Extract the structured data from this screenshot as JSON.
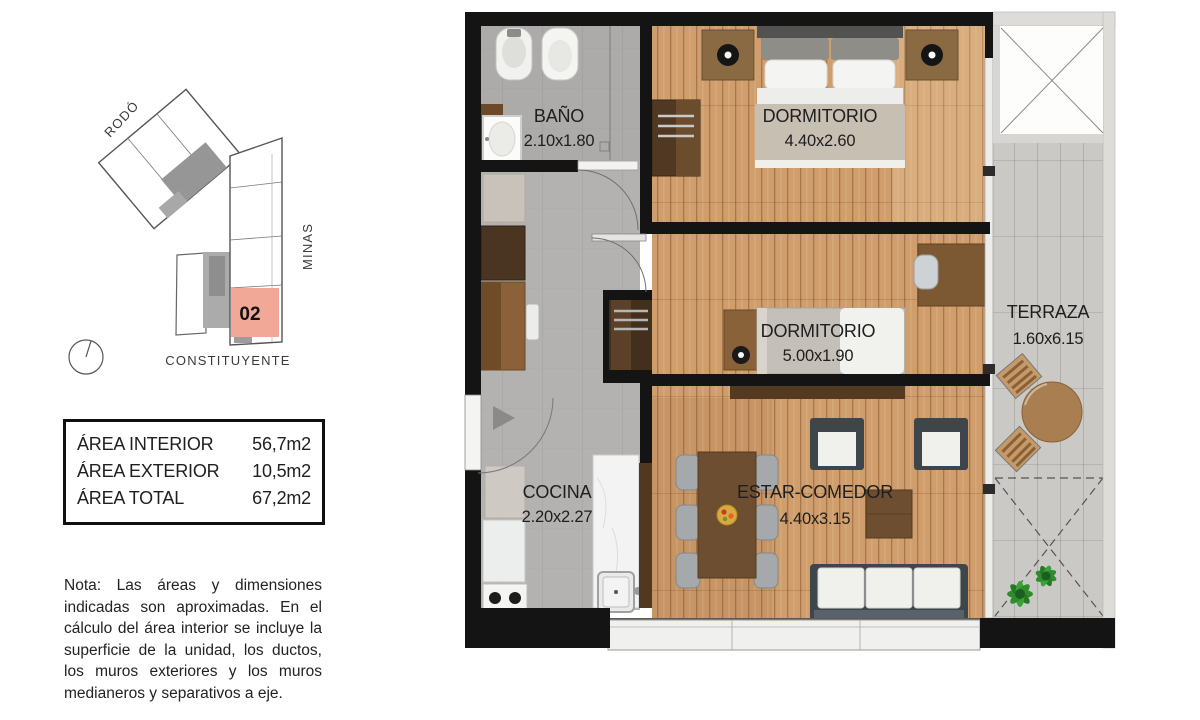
{
  "minimap": {
    "street_top": "RODÓ",
    "street_right": "MINAS",
    "street_bottom": "CONSTITUYENTE",
    "unit_number": "02",
    "unit_highlight_color": "#f2a896"
  },
  "area_table": {
    "rows": [
      {
        "label": "ÁREA INTERIOR",
        "value": "56,7m2"
      },
      {
        "label": "ÁREA EXTERIOR",
        "value": "10,5m2"
      },
      {
        "label": "ÁREA TOTAL",
        "value": "67,2m2"
      }
    ]
  },
  "note": "Nota: Las áreas y dimensiones indicadas son aproximadas. En el cálculo del área interior se incluye la superficie de la unidad, los ductos, los muros exteriores y los muros medianeros y separativos a eje.",
  "floorplan": {
    "rooms": {
      "bano": {
        "name": "BAÑO",
        "dims": "2.10x1.80"
      },
      "dormitorio1": {
        "name": "DORMITORIO",
        "dims": "4.40x2.60"
      },
      "dormitorio2": {
        "name": "DORMITORIO",
        "dims": "5.00x1.90"
      },
      "terraza": {
        "name": "TERRAZA",
        "dims": "1.60x6.15"
      },
      "cocina": {
        "name": "COCINA",
        "dims": "2.20x2.27"
      },
      "estar": {
        "name": "ESTAR-COMEDOR",
        "dims": "4.40x3.15"
      }
    },
    "colors": {
      "wall": "#141414",
      "wood_floor": "#d09e6c",
      "tile_gray": "#b4b2b0",
      "terrace_tile": "#cbc9c6",
      "glass": "#ececea"
    }
  }
}
